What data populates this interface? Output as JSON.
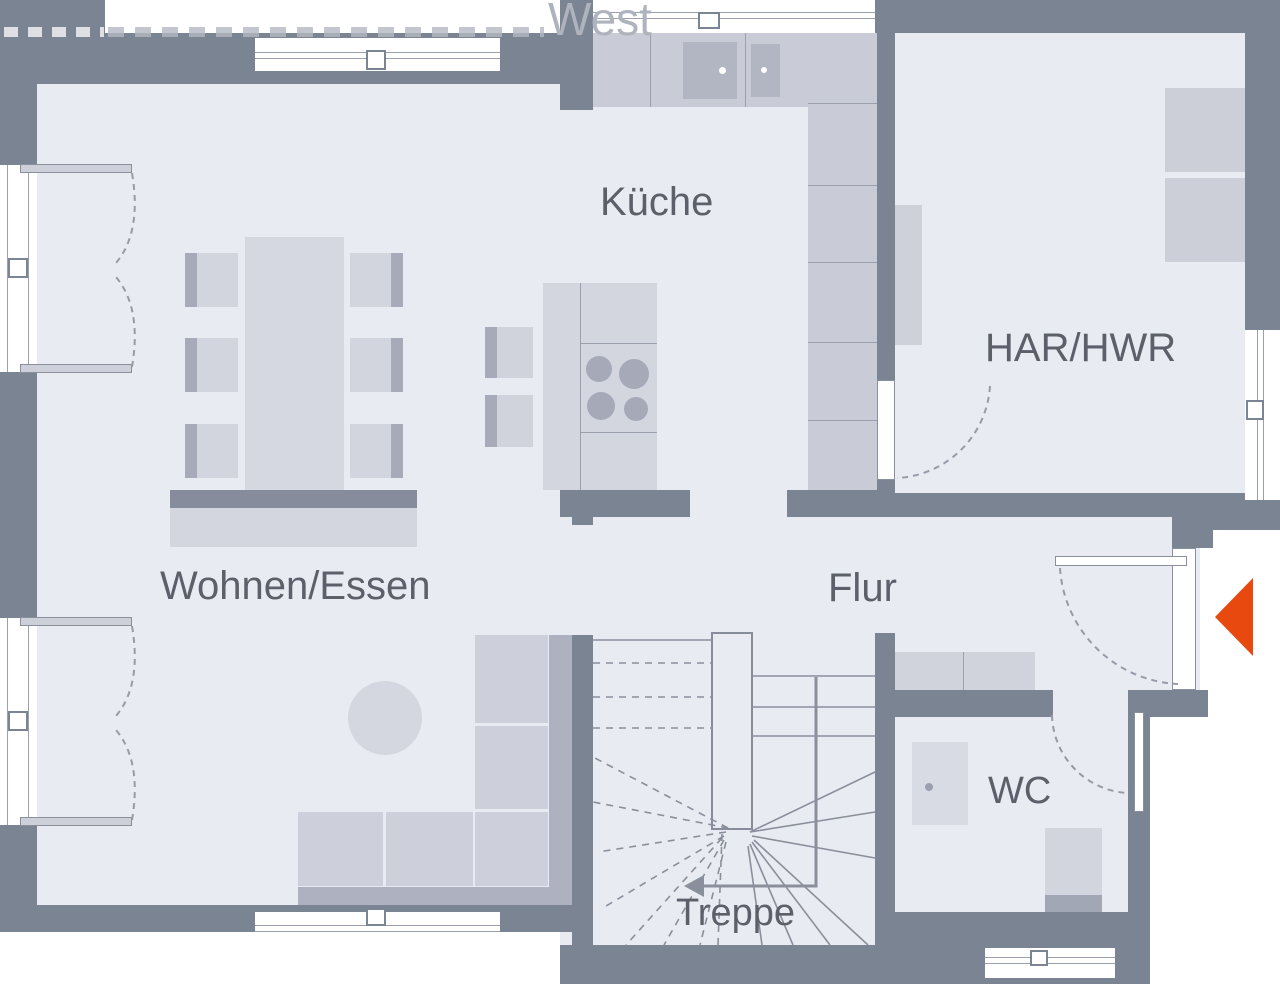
{
  "watermark": {
    "visible_text": "West"
  },
  "rooms": {
    "kitchen": {
      "label": "Küche"
    },
    "utility": {
      "label": "HAR/HWR"
    },
    "living": {
      "label": "Wohnen/Essen"
    },
    "hall": {
      "label": "Flur"
    },
    "wc": {
      "label": "WC"
    },
    "stairs": {
      "label": "Treppe"
    }
  },
  "icons": {
    "entrance_arrow": "left-pointing-triangle",
    "stair_direction_arrow": "left-pointing-arrow"
  },
  "colors": {
    "wall": "#7b8493",
    "floor": "#e9ebf2",
    "furniture_light": "#d2d5de",
    "furniture_mid": "#c9ccd6",
    "furniture_dark": "#a7abb9",
    "entrance_arrow": "#e8490f",
    "label_text": "#5c606a",
    "watermark": "#aeb3bd"
  },
  "furniture": {
    "items": [
      "kitchen-counter",
      "kitchen-sink",
      "kitchen-island",
      "cooktop",
      "bar-stools",
      "dining-table",
      "dining-chairs",
      "sideboard",
      "sofa",
      "rug",
      "hall-bench",
      "utility-shelf",
      "washer",
      "dryer",
      "washbasin",
      "toilet"
    ]
  }
}
